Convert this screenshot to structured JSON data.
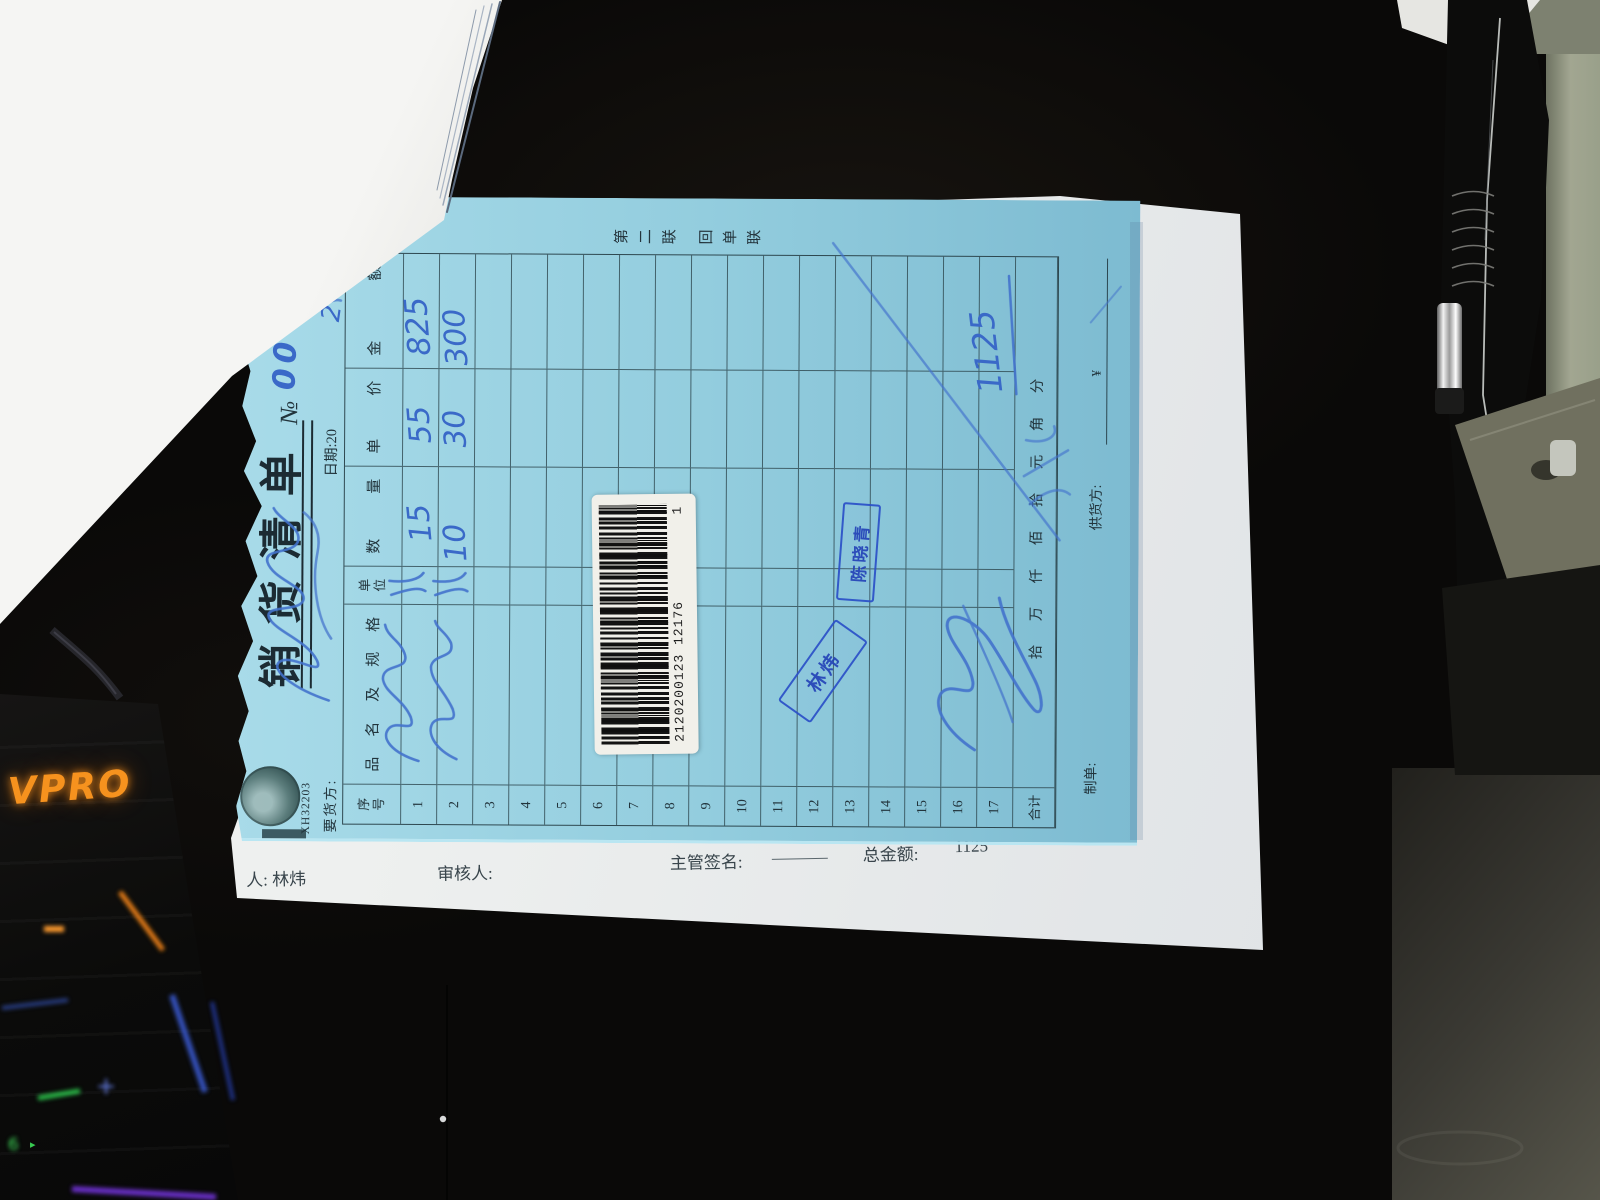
{
  "scene": {
    "keyboard_brand": "VPRO",
    "keyboard_key_plus": "+",
    "keyboard_key_six": "6"
  },
  "strip": {
    "handler": "人:  林炜",
    "reviewer": "审核人:",
    "manager_sign": "主管签名:",
    "total_label": "总金额:",
    "total_value": "1125"
  },
  "document": {
    "form_code": "XH32203",
    "title": "销货清单",
    "serial_prefix": "№",
    "serial_digits": "00",
    "copy_label": "第二联  回单联",
    "buyer_label": "要货方:",
    "date": {
      "prefix": "日期:20",
      "hw_year": "2",
      "year_suffix": "年",
      "hw_month": "1",
      "month_suffix": "月"
    },
    "table": {
      "headers": [
        "序号",
        "品名及规格",
        "单位",
        "数量",
        "单价",
        "金额"
      ],
      "row_count": 17,
      "rows": [
        {
          "no": "1",
          "qty": "15",
          "price": "55",
          "amount": "825"
        },
        {
          "no": "2",
          "qty": "10",
          "price": "30",
          "amount": "300"
        }
      ],
      "total_label": "合计",
      "capitals": "拾万仟佰拾元角分",
      "currency": "¥"
    },
    "footer": {
      "maker_label": "制单:",
      "supplier_label": "供货方:"
    },
    "stamps": {
      "stamp1": "陈晓青",
      "stamp2": "林炜"
    },
    "handwritten_total": "1125",
    "barcode": {
      "digits": "2120200123 12176",
      "suffix": "1"
    }
  },
  "colors": {
    "sheet_blue": "#93cdde",
    "print_ink": "#24363e",
    "pen_blue": "#3f6cc8",
    "stamp_blue": "#2b50c8",
    "glow_orange": "#f6921e"
  }
}
